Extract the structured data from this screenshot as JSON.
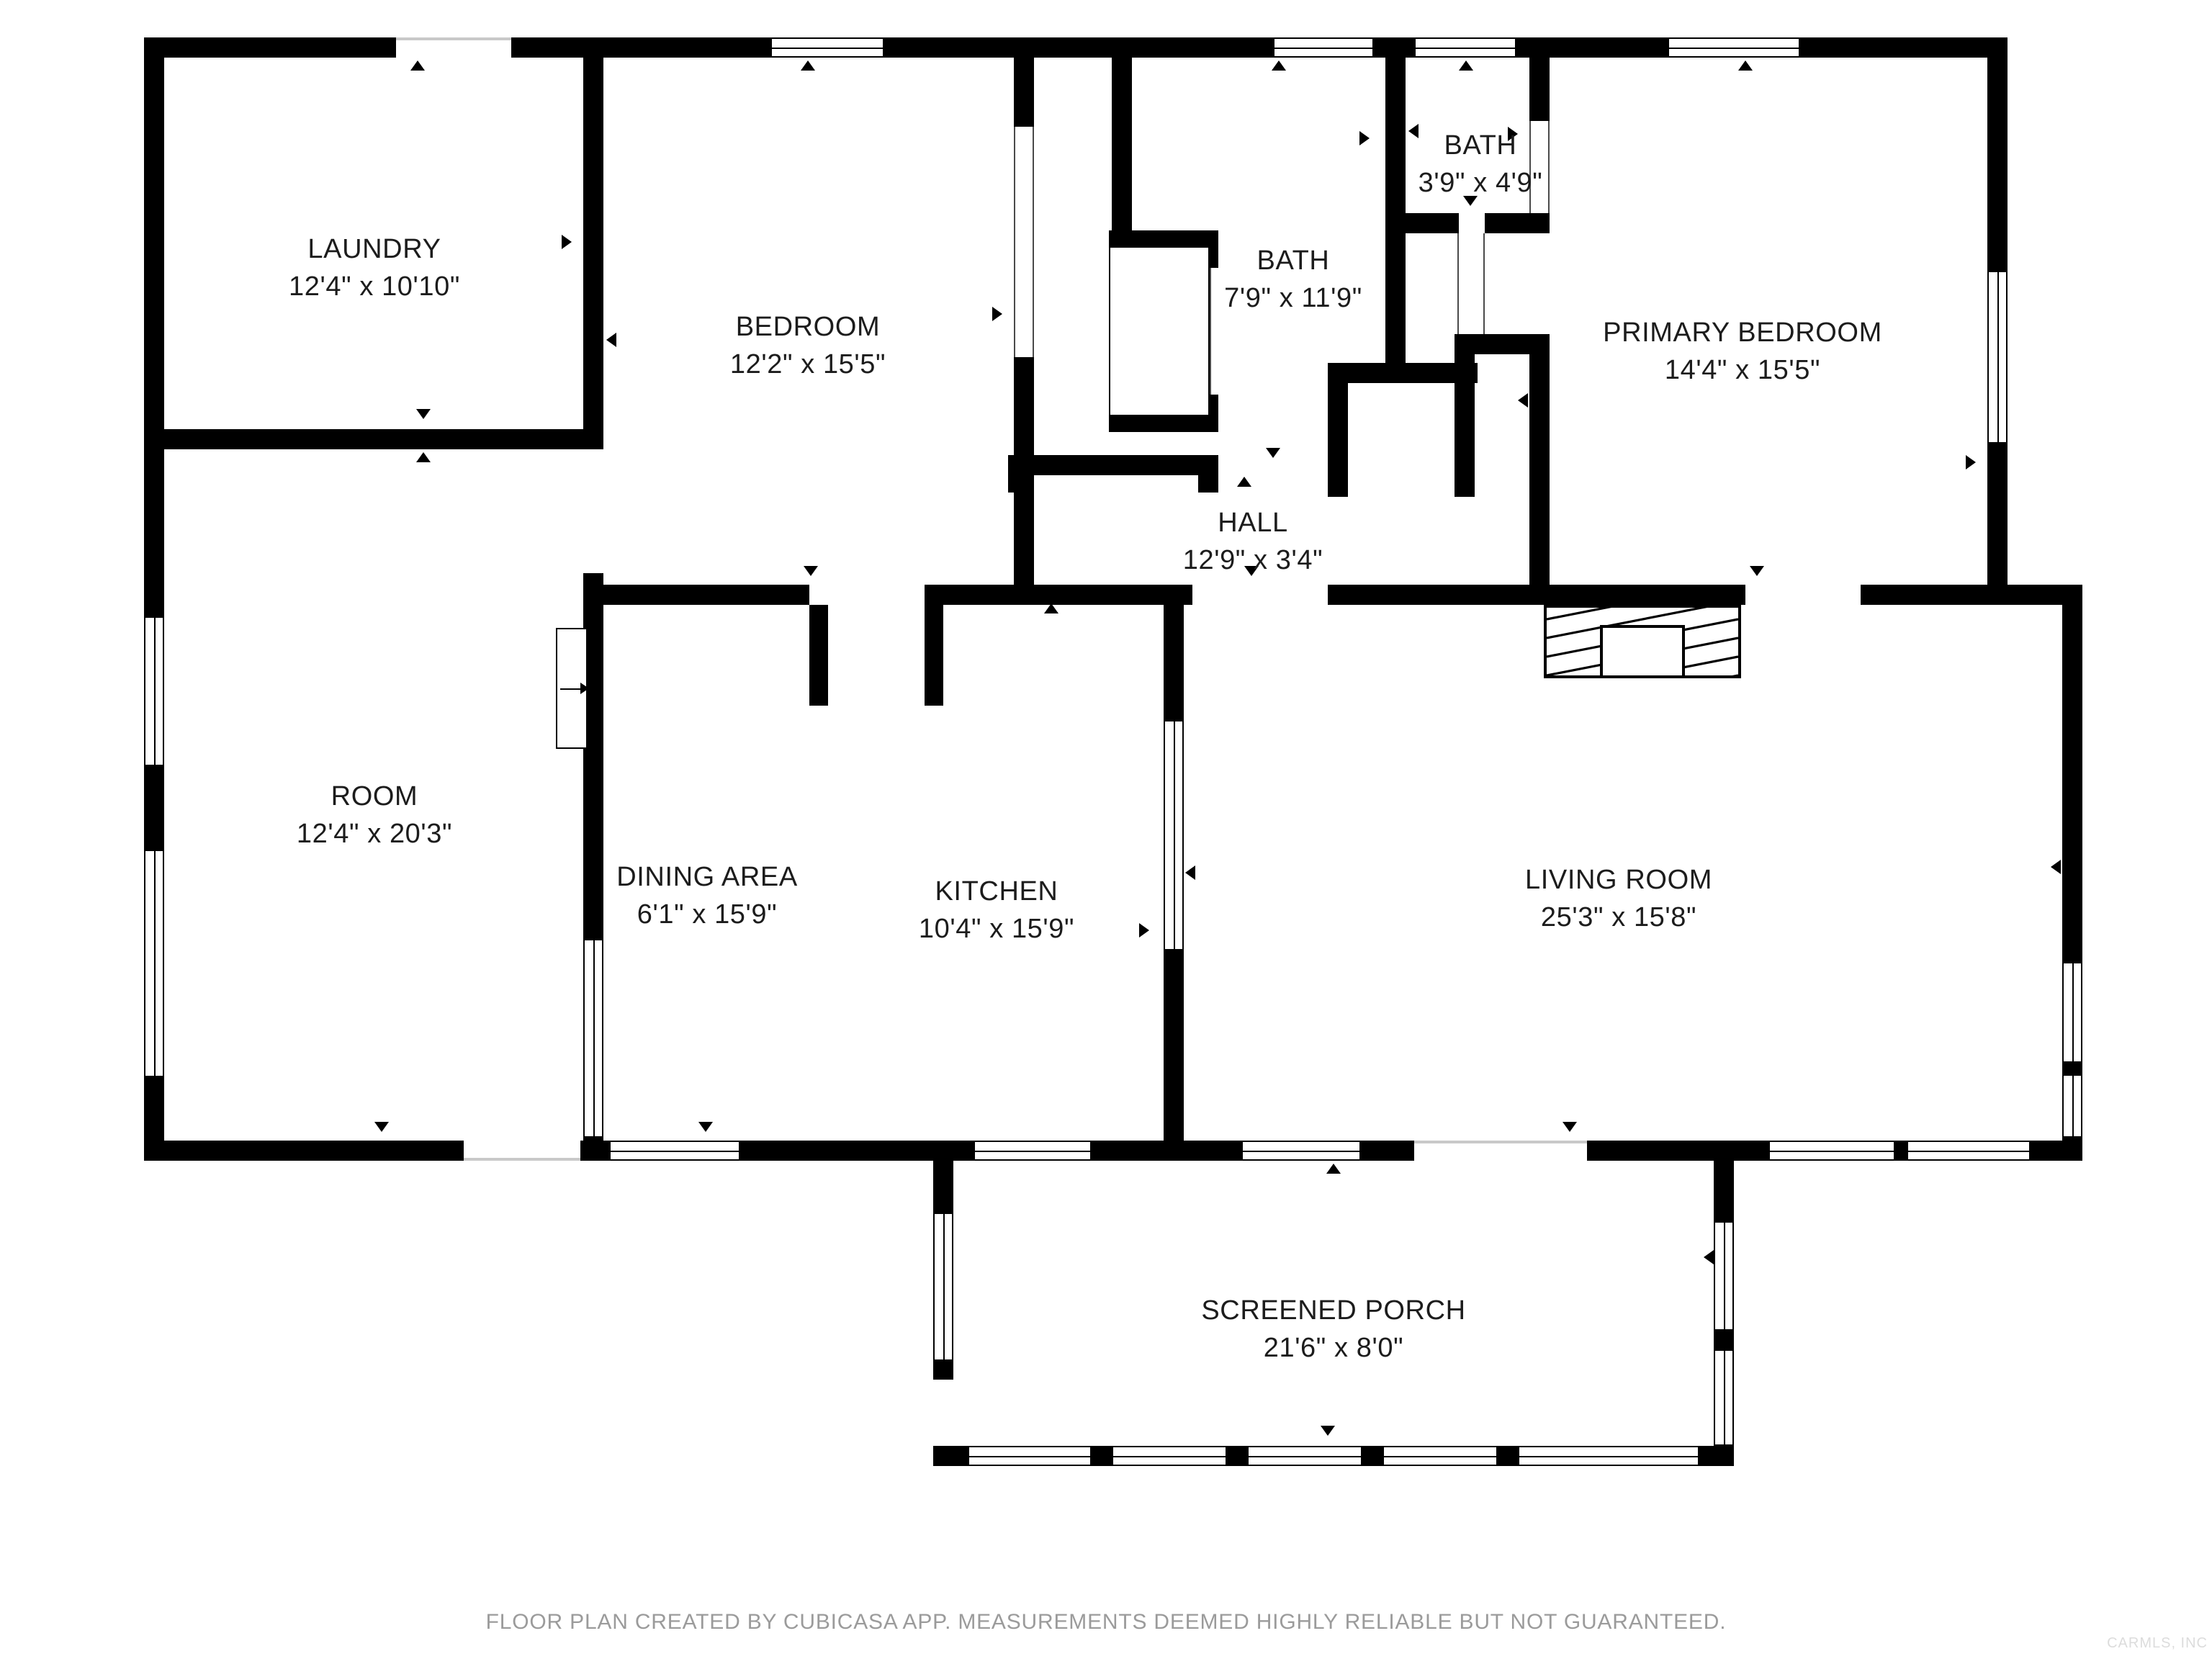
{
  "plan": {
    "rooms": {
      "laundry": {
        "name": "LAUNDRY",
        "dims": "12'4\" x 10'10\""
      },
      "bedroom": {
        "name": "BEDROOM",
        "dims": "12'2\" x 15'5\""
      },
      "bath": {
        "name": "BATH",
        "dims": "7'9\" x 11'9\""
      },
      "bath_small": {
        "name": "BATH",
        "dims": "3'9\" x 4'9\""
      },
      "primary_bedroom": {
        "name": "PRIMARY BEDROOM",
        "dims": "14'4\" x 15'5\""
      },
      "hall": {
        "name": "HALL",
        "dims": "12'9\" x 3'4\""
      },
      "room": {
        "name": "ROOM",
        "dims": "12'4\" x 20'3\""
      },
      "dining_area": {
        "name": "DINING AREA",
        "dims": "6'1\" x 15'9\""
      },
      "kitchen": {
        "name": "KITCHEN",
        "dims": "10'4\" x 15'9\""
      },
      "living_room": {
        "name": "LIVING ROOM",
        "dims": "25'3\" x 15'8\""
      },
      "screened_porch": {
        "name": "SCREENED PORCH",
        "dims": "21'6\" x 8'0\""
      }
    },
    "footer_disclaimer": "FLOOR PLAN CREATED BY CUBICASA APP. MEASUREMENTS DEEMED HIGHLY RELIABLE BUT NOT GUARANTEED.",
    "watermark": "CARMLS, INC",
    "colors": {
      "wall": "#000000",
      "background": "#ffffff",
      "label_text": "#1c1c1c",
      "footer_text": "#9b9b9b",
      "watermark_text": "#dcdcdc"
    }
  }
}
